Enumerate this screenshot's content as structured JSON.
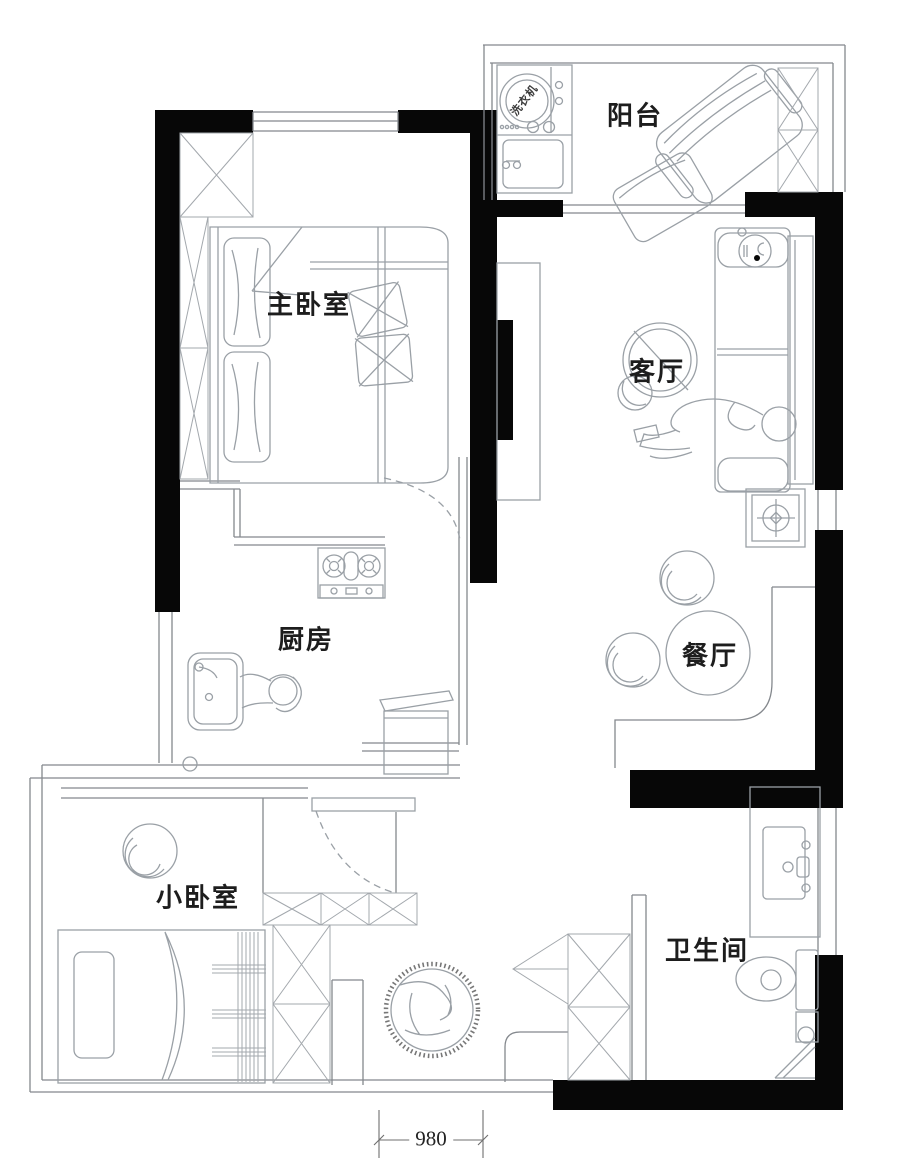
{
  "plan": {
    "type": "apartment-floor-plan",
    "rooms": [
      {
        "id": "balcony",
        "label": "阳台"
      },
      {
        "id": "master-bedroom",
        "label": "主卧室"
      },
      {
        "id": "living-room",
        "label": "客厅"
      },
      {
        "id": "kitchen",
        "label": "厨房"
      },
      {
        "id": "dining-room",
        "label": "餐厅"
      },
      {
        "id": "small-bedroom",
        "label": "小卧室"
      },
      {
        "id": "bathroom",
        "label": "卫生间"
      }
    ],
    "appliance_labels": {
      "washing_machine": "洗衣机"
    },
    "dimensions": {
      "entry_door_width": "980"
    },
    "furniture": [
      "washing-machine",
      "laundry-sink",
      "lounge-chair",
      "balcony-cabinet",
      "wardrobe",
      "double-bed",
      "tv-cabinet",
      "sofa",
      "round-armchair",
      "floor-speaker",
      "dining-table",
      "dining-chair",
      "gas-stove",
      "kitchen-sink",
      "lidded-appliance",
      "single-bed",
      "tub-chair",
      "shoe-cabinet",
      "bathroom-vanity",
      "toilet",
      "corner-mop-pool",
      "decor-rug"
    ],
    "colors": {
      "background": "#ffffff",
      "wall": "#070707",
      "line": "#84888d",
      "furniture": "#9aa0a6",
      "text": "#1d1d1d"
    }
  }
}
